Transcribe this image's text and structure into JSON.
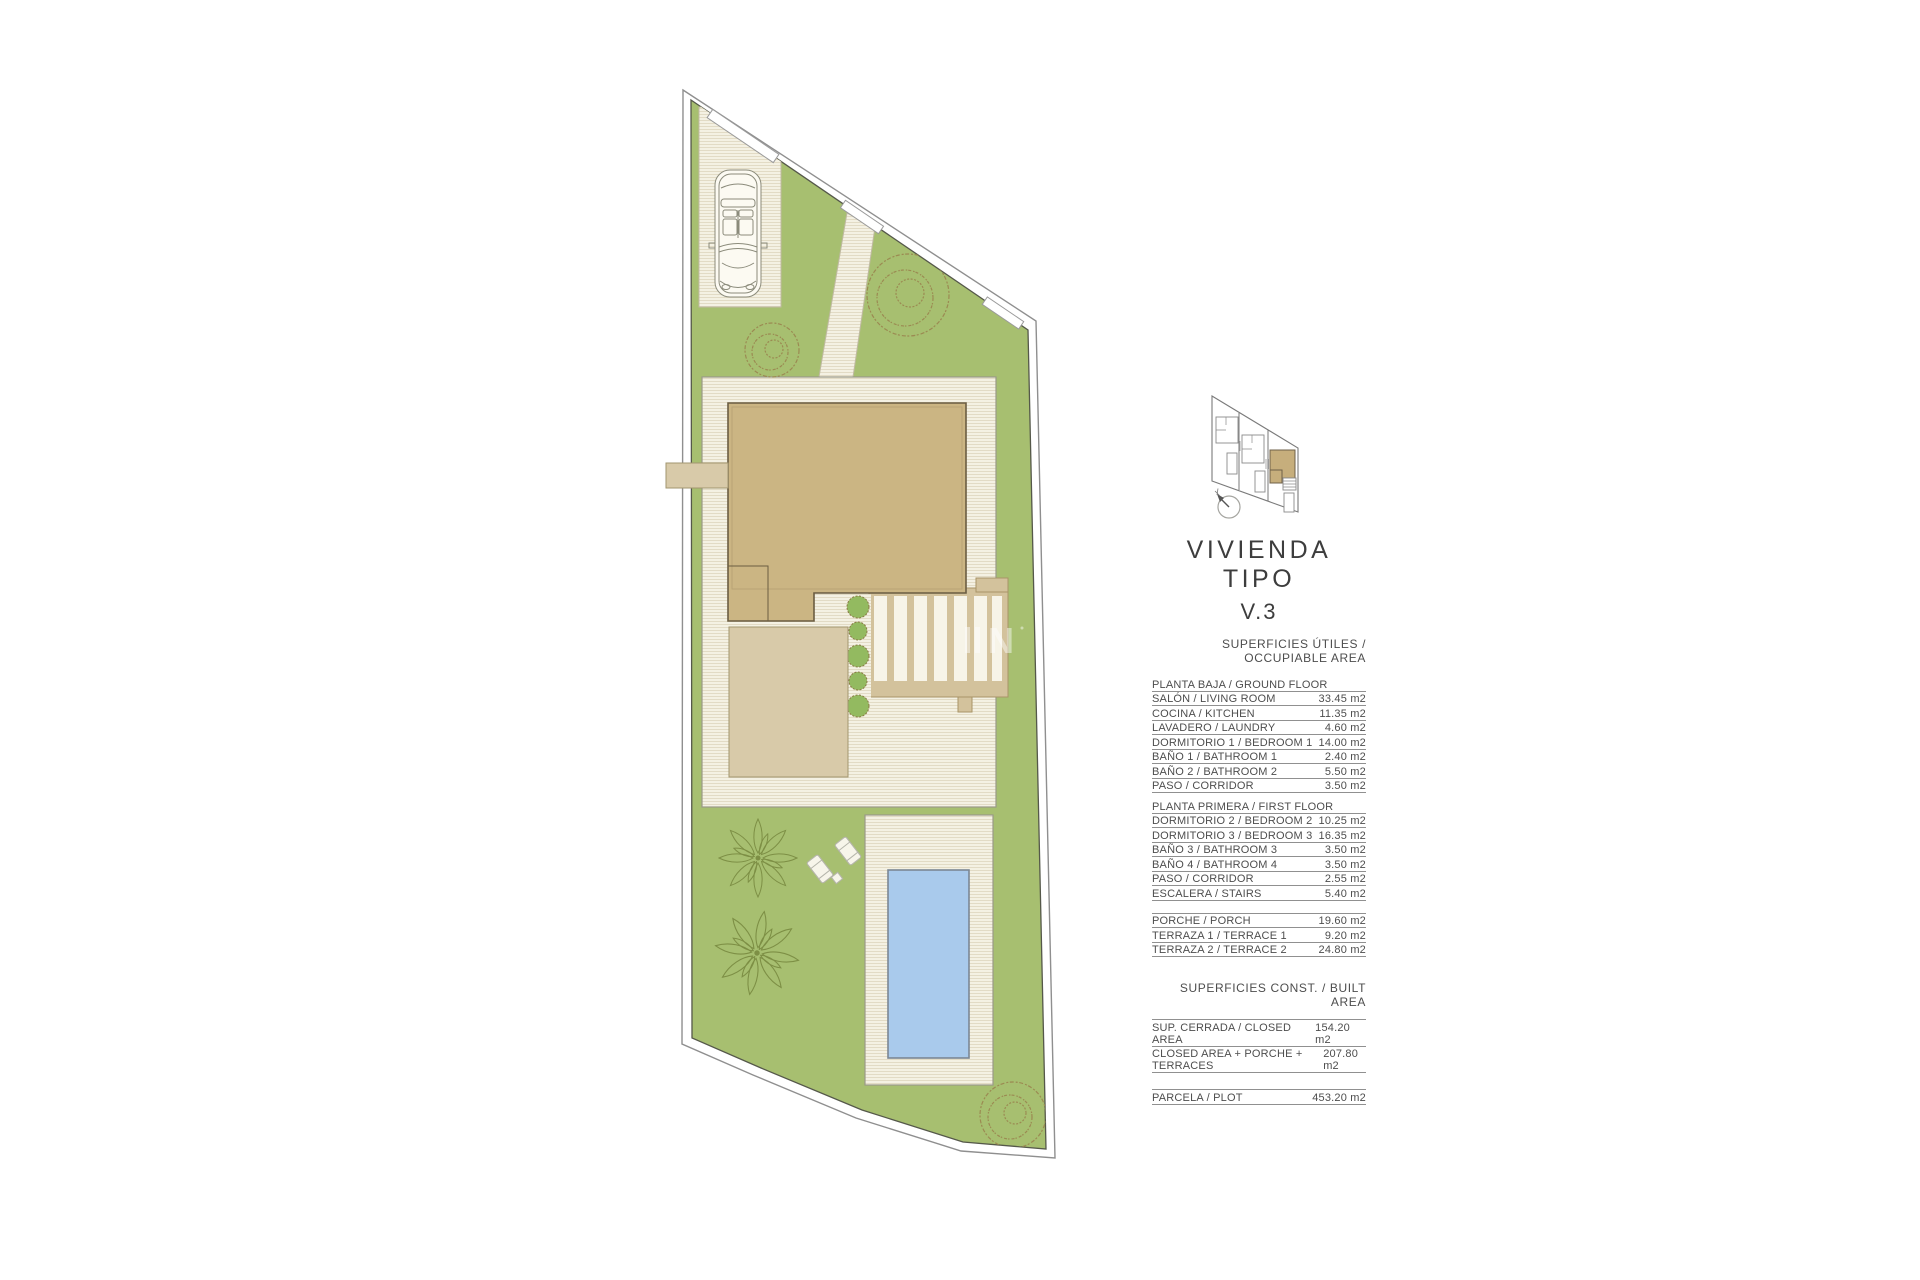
{
  "title": {
    "line1": "VIVIENDA TIPO",
    "line2": "V.3"
  },
  "areas": {
    "occupiable_header": "SUPERFICIES ÚTILES / OCCUPIABLE AREA",
    "built_header": "SUPERFICIES  CONST. / BUILT AREA",
    "ground": {
      "label": "PLANTA BAJA / GROUND FLOOR",
      "rows": [
        [
          "SALÓN / LIVING ROOM",
          "33.45 m2"
        ],
        [
          "COCINA / KITCHEN",
          "11.35 m2"
        ],
        [
          "LAVADERO / LAUNDRY",
          "4.60 m2"
        ],
        [
          "DORMITORIO 1 /  BEDROOM 1",
          "14.00 m2"
        ],
        [
          "BAÑO 1 / BATHROOM 1",
          "2.40 m2"
        ],
        [
          "BAÑO 2 / BATHROOM 2",
          "5.50 m2"
        ],
        [
          "PASO / CORRIDOR",
          "3.50 m2"
        ]
      ]
    },
    "first": {
      "label": "PLANTA PRIMERA / FIRST FLOOR",
      "rows": [
        [
          "DORMITORIO 2 / BEDROOM 2",
          "10.25 m2"
        ],
        [
          "DORMITORIO 3 / BEDROOM 3",
          "16.35 m2"
        ],
        [
          "BAÑO 3 / BATHROOM 3",
          "3.50 m2"
        ],
        [
          "BAÑO 4 / BATHROOM 4",
          "3.50 m2"
        ],
        [
          "PASO / CORRIDOR",
          "2.55 m2"
        ],
        [
          "ESCALERA / STAIRS",
          "5.40 m2"
        ]
      ]
    },
    "outdoor": {
      "rows": [
        [
          "PORCHE / PORCH",
          "19.60 m2"
        ],
        [
          "TERRAZA 1 / TERRACE 1",
          "9.20 m2"
        ],
        [
          "TERRAZA 2 / TERRACE 2",
          "24.80 m2"
        ]
      ]
    },
    "built": {
      "rows": [
        [
          "SUP. CERRADA / CLOSED AREA",
          "154.20 m2"
        ],
        [
          "CLOSED AREA + PORCHE + TERRACES",
          "207.80 m2"
        ]
      ]
    },
    "plot": {
      "rows": [
        [
          "PARCELA / PLOT",
          "453.20 m2"
        ]
      ]
    }
  },
  "colors": {
    "lawn": "#a7bf70",
    "paving": "#f4f1e3",
    "paving-line": "#e2dbc5",
    "roof": "#cbb583",
    "roof-outline": "#6b5d42",
    "porch": "#d8caa9",
    "deck-beige": "#d3c29c",
    "pool": "#a9caec",
    "pool-outline": "#7b8795",
    "boundary": "#55584a",
    "tree": "#9b8a52",
    "palm": "#7d8f45",
    "bush": "#93ba60",
    "highlight": "#c6ae7c",
    "text": "#4d4d4d",
    "rule": "#909090"
  }
}
